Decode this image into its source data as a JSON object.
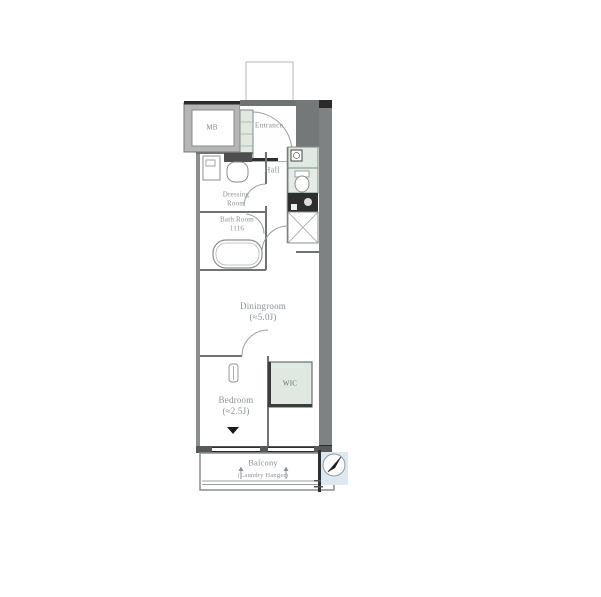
{
  "title": "apartment-floor-plan",
  "labels": {
    "meter_box": "MB",
    "entrance": "Entrance",
    "hall": "Hall",
    "dressing_room": "Dressing\nRoom",
    "bath_room": "Bath Room\n1116",
    "dining_room": "Diningroom\n(≈5.0J)",
    "bedroom": "Bedroom\n(≈2.5J)",
    "closet": "WIC",
    "balcony": "Balcony",
    "laundry_hanger": "(Laundry Hanger)"
  },
  "icons": {
    "north_arrow": "north-arrow-icon",
    "bathtub": "bathtub-icon",
    "toilet": "toilet-icon",
    "washbasin": "washbasin-icon",
    "washer": "washing-machine-icon",
    "stove": "stove-icon",
    "door_arcs": "door-swing-icon"
  },
  "colors": {
    "wall": "#7e8282",
    "wall_dark": "#2b2b2b",
    "line": "#9aa0a0",
    "wet_area": "#dfe9e2",
    "label_text": "#8b9196",
    "compass_bg": "#dde8f1",
    "stove_fill": "#2e2e2e"
  }
}
